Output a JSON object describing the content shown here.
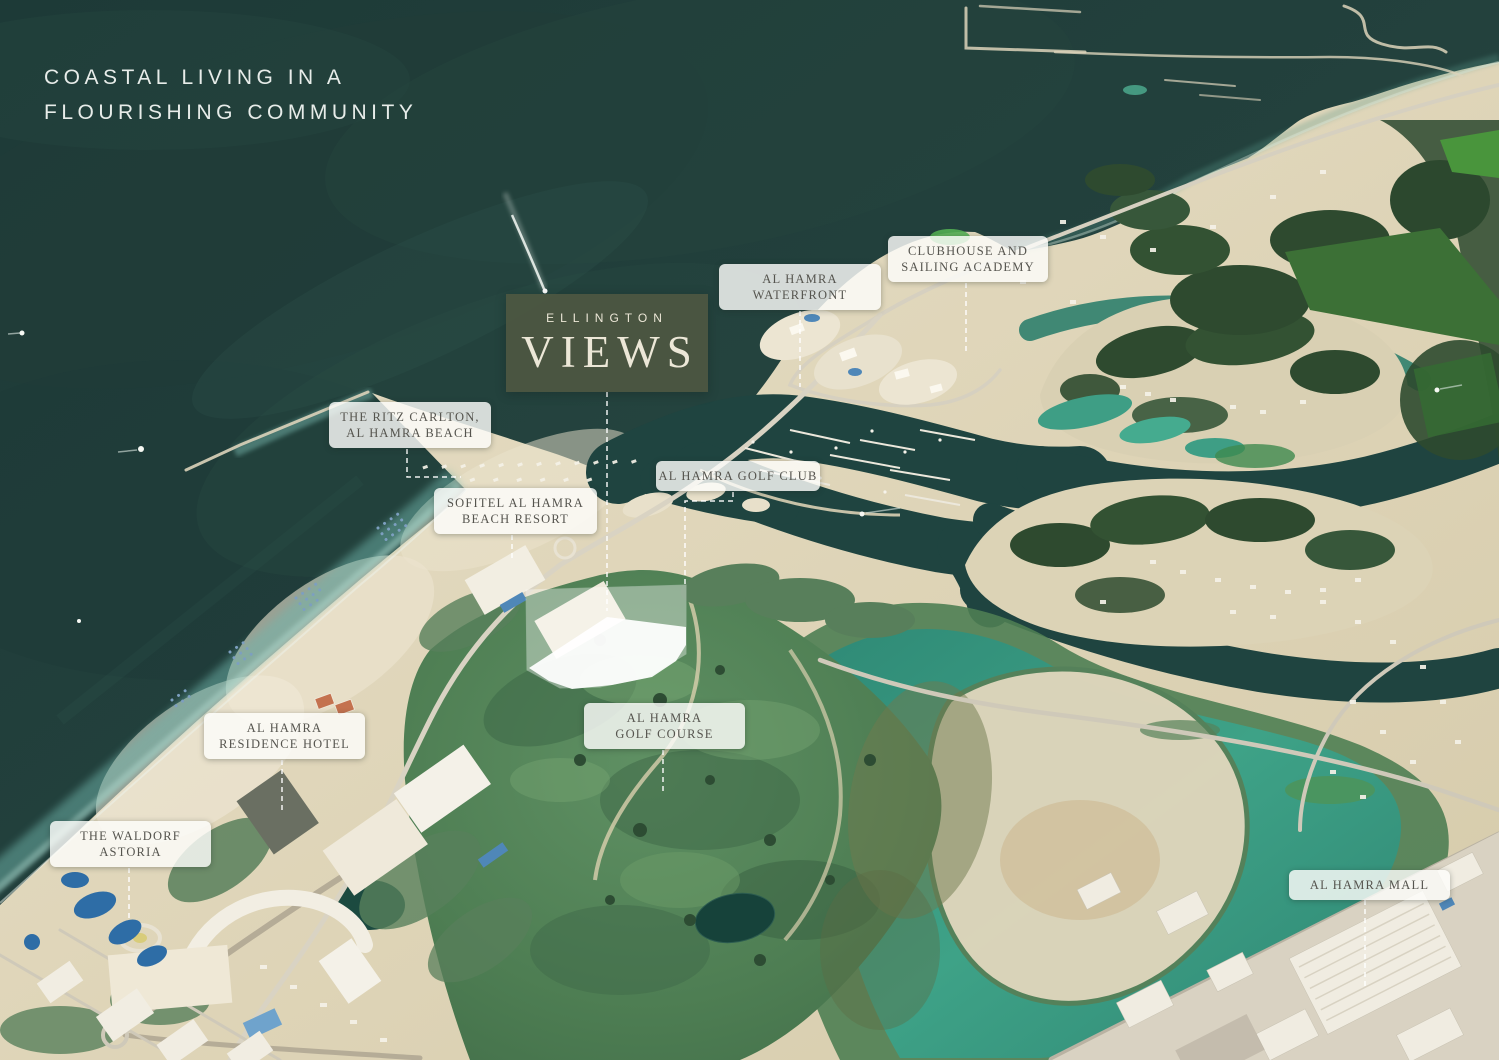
{
  "canvas": {
    "width": 1499,
    "height": 1060
  },
  "headline": {
    "lines": [
      "COASTAL LIVING IN A",
      "FLOURISHING COMMUNITY"
    ]
  },
  "logo": {
    "brand": "ELLINGTON",
    "name": "VIEWS",
    "leader": "607,392 607,611"
  },
  "map_labels": [
    {
      "id": "al-hamra-waterfront",
      "lines": [
        "AL HAMRA",
        "WATERFRONT"
      ],
      "x": 719,
      "y": 264,
      "w": 158,
      "leader": "800,311 800,387"
    },
    {
      "id": "clubhouse-sailing-academy",
      "lines": [
        "CLUBHOUSE AND",
        "SAILING ACADEMY"
      ],
      "x": 888,
      "y": 236,
      "w": 156,
      "leader": "966,283 966,355"
    },
    {
      "id": "ritz-carlton-al-hamra-beach",
      "lines": [
        "THE RITZ CARLTON,",
        "AL HAMRA BEACH"
      ],
      "x": 329,
      "y": 402,
      "w": 158,
      "leader": "407,449 407,477 461,477"
    },
    {
      "id": "sofitel-al-hamra-beach-resort",
      "lines": [
        "SOFITEL AL HAMRA",
        "BEACH RESORT"
      ],
      "x": 434,
      "y": 488,
      "w": 159,
      "leader": "512,535 512,560"
    },
    {
      "id": "al-hamra-golf-club",
      "lines": [
        "AL HAMRA GOLF CLUB"
      ],
      "x": 656,
      "y": 461,
      "w": 160,
      "leader": "733,492 733,501 685,501 685,587"
    },
    {
      "id": "al-hamra-golf-course",
      "lines": [
        "AL HAMRA",
        "GOLF COURSE"
      ],
      "x": 584,
      "y": 703,
      "w": 157,
      "leader": "663,750 663,795"
    },
    {
      "id": "al-hamra-residence-hotel",
      "lines": [
        "AL HAMRA",
        "RESIDENCE HOTEL"
      ],
      "x": 204,
      "y": 713,
      "w": 157,
      "leader": "282,760 282,811"
    },
    {
      "id": "the-waldorf-astoria",
      "lines": [
        "THE WALDORF",
        "ASTORIA"
      ],
      "x": 50,
      "y": 821,
      "w": 157,
      "leader": "129,868 129,920"
    },
    {
      "id": "al-hamra-mall",
      "lines": [
        "AL HAMRA MALL"
      ],
      "x": 1289,
      "y": 870,
      "w": 157,
      "leader": "1365,900 1365,987"
    }
  ],
  "colors": {
    "ocean": "#22403c",
    "sand": "#e2d9bf",
    "golf_green": "#4e7e53",
    "lagoon": "#3ea287",
    "label_bg": "rgba(252,252,250,0.82)",
    "label_text": "#55544e",
    "logo_bg": "#4d5742",
    "logo_text": "#ece7d7",
    "headline_text": "#e7ece9",
    "leader_line": "rgba(255,255,255,0.92)",
    "site_highlight": "#ffffff"
  }
}
